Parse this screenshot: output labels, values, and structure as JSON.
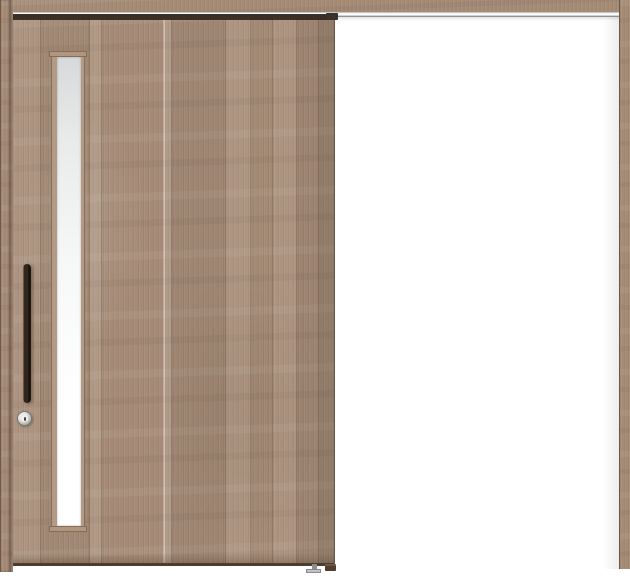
{
  "image": {
    "kind": "product-photo",
    "subject": "Single-panel wall-mounted sliding interior door, shown open position on left with hanging rail extending right over white wall",
    "background_color": "#ffffff"
  },
  "palette": {
    "wood_base": "#a88e79",
    "wood_light": "#bda489",
    "wood_dark": "#8d7361",
    "wood_edge_line": "#6a5645",
    "handle_black": "#2a201a",
    "track_silver_highlight": "#ffffff",
    "track_silver_shadow": "#6d6d6d",
    "glass_top": "#d7d9da",
    "glass_bottom": "#ffffff",
    "lock_ring_metal": "#8f8f8d",
    "lock_face": "#f0f0ee",
    "wall": "#ffffff"
  },
  "parts": {
    "header_rail": "wood hanging-rail cover across full width",
    "track": "metal slide track under header rail",
    "left_casing": "left vertical wood frame casing",
    "right_casing": "right vertical wood frame casing",
    "door_panel": "wood-grain sliding door panel (left half)",
    "glass_insert": "slim vertical frosted glass window near handle side",
    "handle": "vertical dark-bronze bar pull handle",
    "lock": "round chrome thumb-turn lock below handle",
    "hanger_bracket": "dark hanger roller bracket at door top-right corner",
    "floor_guide": "small metal floor guide at door bottom edge",
    "door_stopper": "dark bottom stopper block at door lower-right corner"
  }
}
